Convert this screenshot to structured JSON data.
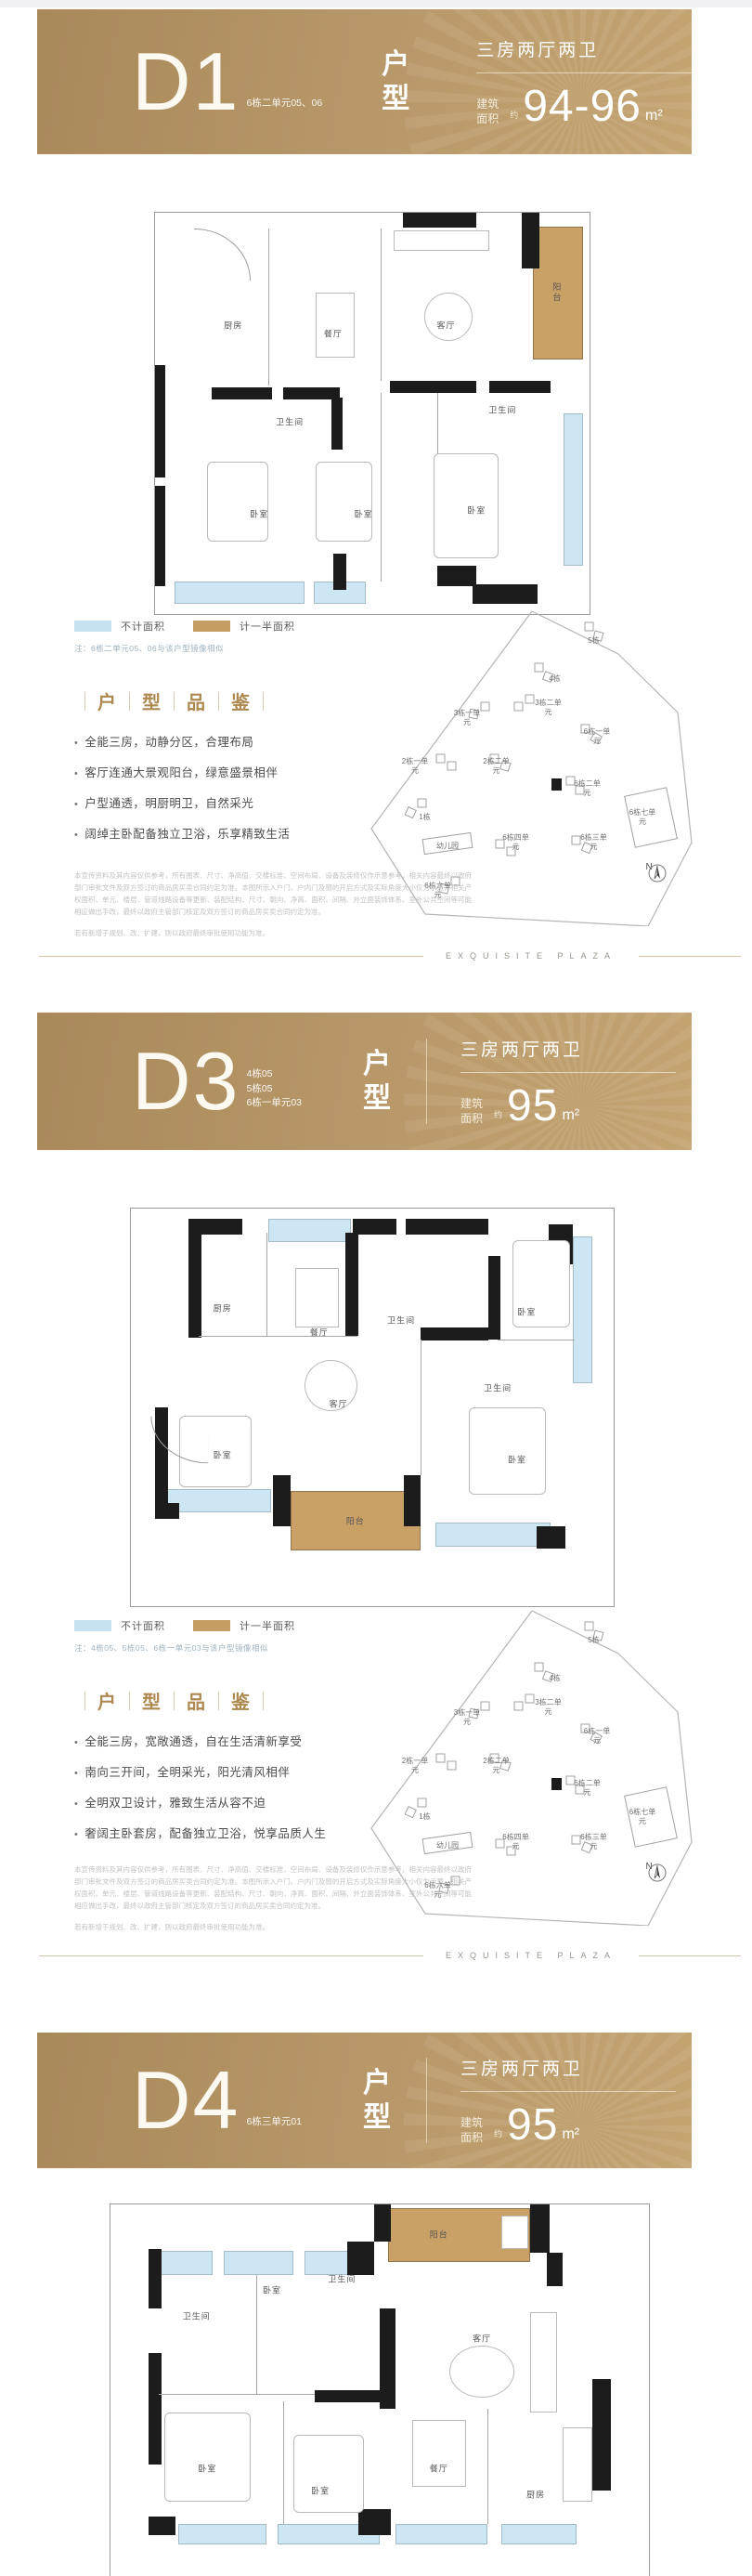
{
  "rooms": {
    "living": "客厅",
    "dining": "餐厅",
    "kitchen": "厨房",
    "bedroom": "卧室",
    "bath": "卫生间",
    "balcony": "阳台"
  },
  "legend": {
    "no_area": "不计面积",
    "half_area": "计一半面积"
  },
  "appraisal": [
    "户",
    "型",
    "品",
    "鉴"
  ],
  "compass": {
    "n": "N"
  },
  "brand": {
    "name": "EXQUISITE PLAZA"
  },
  "disclaimer": {
    "p1": "本宣传资料及其内容仅供参考，所有图表、尺寸、净高值、交楼标准、空间布局、设备及装修仅作示意参考，相关内容最终以政府部门审批文件及双方签订的商品房买卖合同约定为准。本图所示入户门、户内门及窗的开启方式及实际角度大小仅为示意，相关产权面积、单元、楼层、管道线路设备等更新、装配结构、尺寸、朝向、净高、面积、间隔、外立面装饰体系、室外公共空间等可能相应做出手改，最终以政府主管部门核定及双方签订的商品房买卖合同约定为准。",
    "p2": "若有新增于规划、改、扩建，则以政府最终审批使用功能为准。"
  },
  "sitemap": {
    "labels": [
      "5栋",
      "4栋",
      "3栋二单元",
      "3栋一单元",
      "6栋一单元",
      "2栋一单元",
      "2栋二单元",
      "6栋二单元",
      "6栋七单元",
      "1栋",
      "幼儿园",
      "6栋四单元",
      "6栋三单元",
      "6栋六单元"
    ]
  },
  "sections": [
    {
      "name": "D1",
      "type_label": "户型",
      "spec": "三房两厅两卫",
      "sub": [
        "6栋二单元05、06"
      ],
      "area_label": "建筑面积",
      "approx": "约",
      "area_value": "94-96",
      "area_unit": "m²",
      "note": "注：6栋二单元05、06与该户型镜像相似",
      "bullets": [
        "全能三房，动静分区，合理布局",
        "客厅连通大景观阳台，绿意盛景相伴",
        "户型通透，明厨明卫，自然采光",
        "阔绰主卧配备独立卫浴，乐享精致生活"
      ]
    },
    {
      "name": "D3",
      "type_label": "户型",
      "spec": "三房两厅两卫",
      "sub": [
        "4栋05",
        "5栋05",
        "6栋一单元03"
      ],
      "area_label": "建筑面积",
      "approx": "约",
      "area_value": "95",
      "area_unit": "m²",
      "note": "注：4栋05、5栋05、6栋一单元03与该户型镜像相似",
      "bullets": [
        "全能三房，宽敞通透，自在生活清新享受",
        "南向三开间，全明采光，阳光清风相伴",
        "全明双卫设计，雅致生活从容不迫",
        "奢阔主卧套房，配备独立卫浴，悦享品质人生"
      ]
    },
    {
      "name": "D4",
      "type_label": "户型",
      "spec": "三房两厅两卫",
      "sub": [
        "6栋三单元01"
      ],
      "area_label": "建筑面积",
      "approx": "约",
      "area_value": "95",
      "area_unit": "m²"
    }
  ]
}
